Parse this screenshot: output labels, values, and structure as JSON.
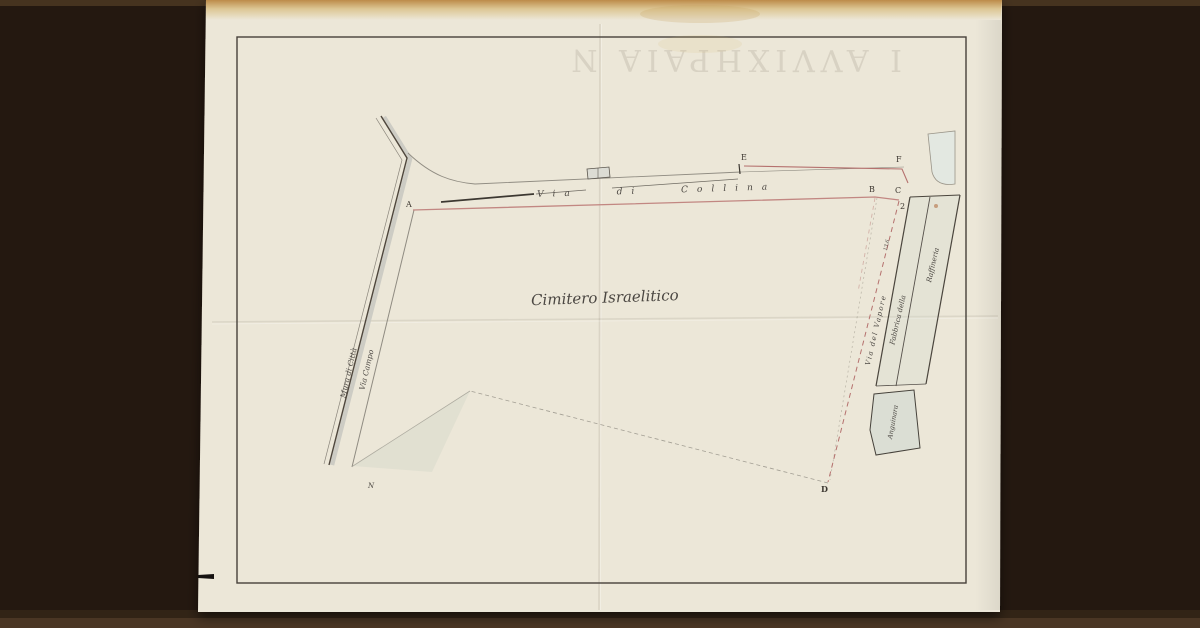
{
  "scan": {
    "bleedthrough_glyphs": "I AVVIXHPAIA N"
  },
  "plan": {
    "area_label": "Cimitero Israelitico",
    "roads": {
      "top_road": "Via di Collina",
      "left_wall": "Mura di Città",
      "left_road": "Via Campo",
      "right_road": "Via del Vapore"
    },
    "buildings": {
      "factory_line1": "Fabbrica della",
      "factory_line2": "Raffineria",
      "lower_block": "Anguinara"
    },
    "points": {
      "a": "A",
      "b": "B",
      "c": "C",
      "c2": "2",
      "d": "D",
      "e": "E",
      "f": "F"
    },
    "annotations": {
      "measure": "13,6",
      "north_mark": "N"
    }
  },
  "colors": {
    "background": "#241810",
    "paper": "#ece7d8",
    "red_line": "#b5716e",
    "ink": "#4b4742"
  }
}
